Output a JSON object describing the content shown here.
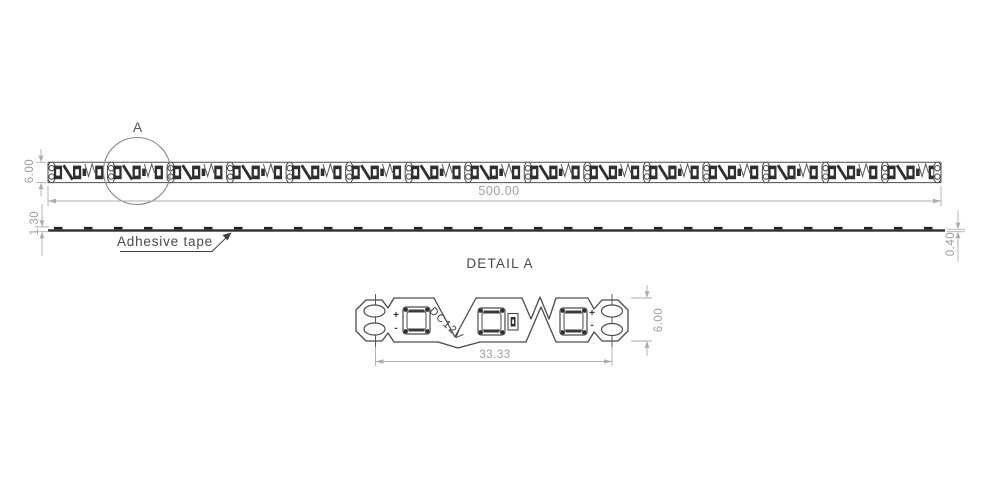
{
  "top_view": {
    "detail_marker": "A",
    "length_dim": "500.00",
    "width_dim": "6.00"
  },
  "side_view": {
    "adhesive_label": "Adhesive tape",
    "total_thickness_dim": "1.30",
    "tape_thickness_dim": "0.40"
  },
  "detail_view": {
    "title": "DETAIL A",
    "segment_length_dim": "33.33",
    "width_dim": "6.00",
    "voltage_label": "DC12V",
    "plus_left": "+",
    "minus_left": "-",
    "plus_right": "+",
    "minus_right": "-"
  },
  "colors": {
    "drawing_line": "#4a4a4a",
    "dimension_line": "#adadad",
    "dimension_text": "#9e9e9e",
    "label_text": "#4d4d4d",
    "component_fill": "#2f2f2f",
    "background": "#ffffff"
  }
}
